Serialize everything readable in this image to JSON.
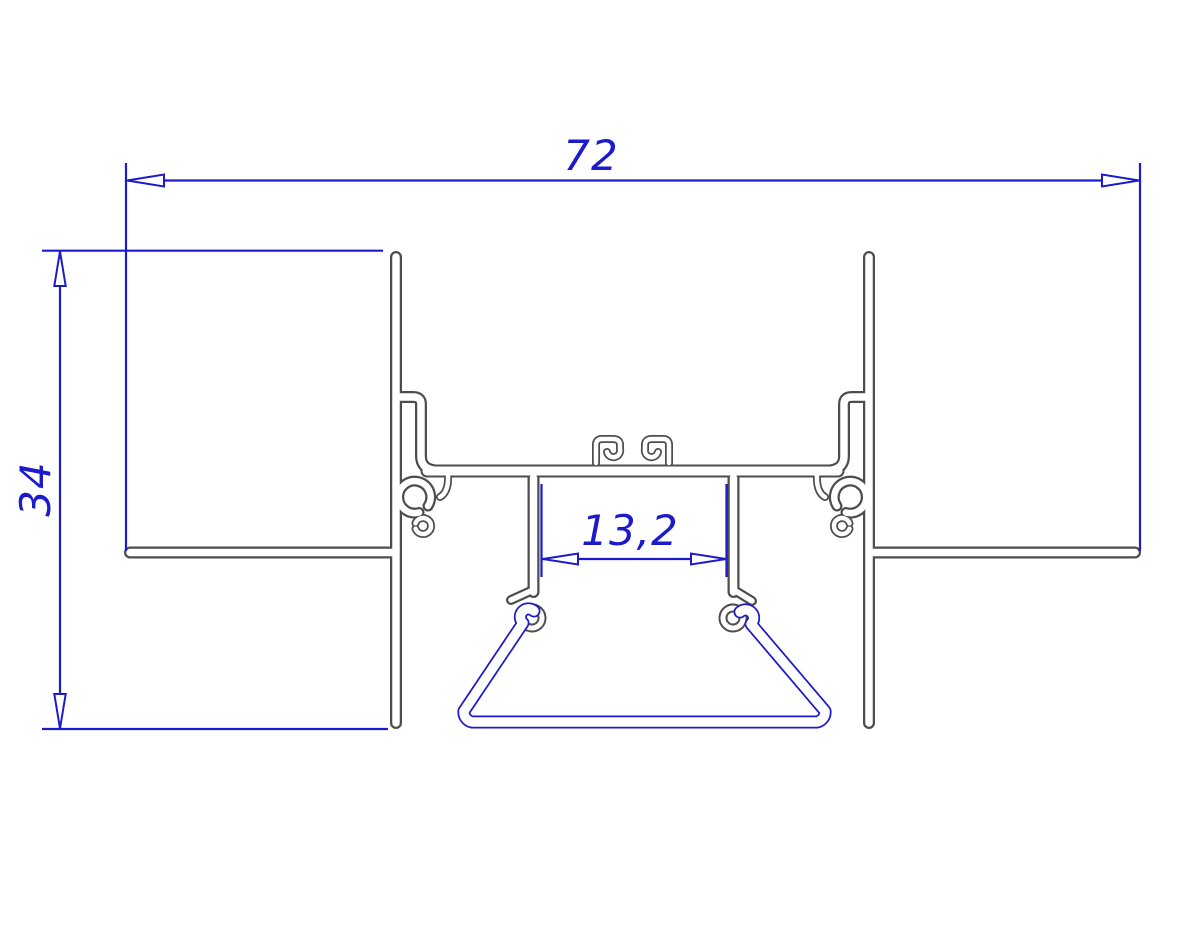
{
  "drawing": {
    "kind": "aluminium-profile-cross-section",
    "dimensions": {
      "overall_width": {
        "value": "72"
      },
      "overall_height": {
        "value": "34"
      },
      "slot_width": {
        "value": "13,2"
      }
    },
    "colors": {
      "dimension_blue": "#1b1bcb",
      "profile_gray": "#4d4d4d",
      "spring_blue": "#1b1bcb",
      "background": "#ffffff"
    }
  }
}
